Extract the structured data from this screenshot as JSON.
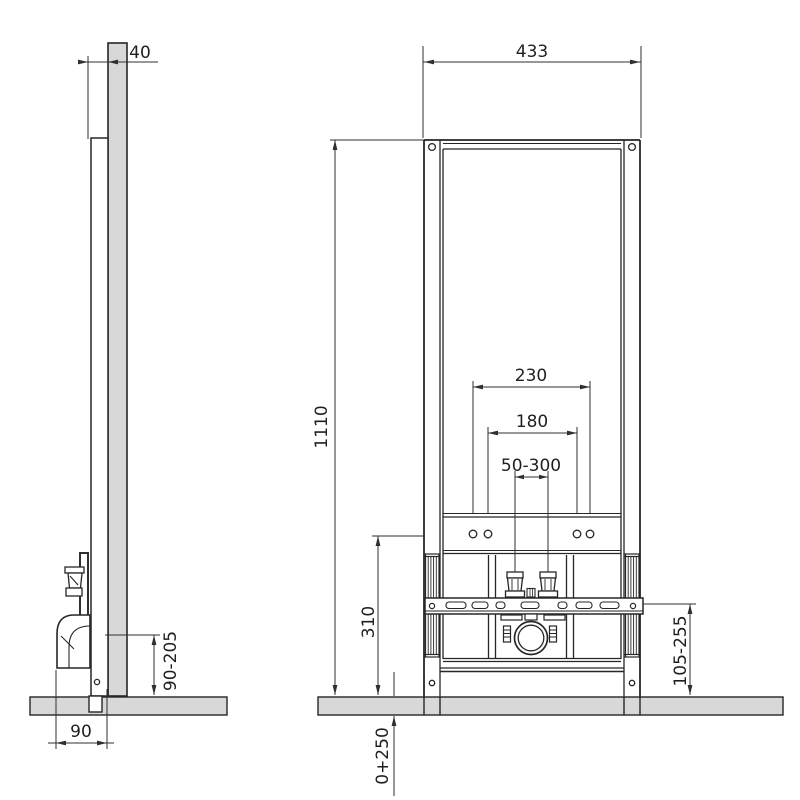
{
  "dimensions": {
    "frame_depth": "40",
    "frame_width": "433",
    "frame_height": "1110",
    "fixing_span_outer": "230",
    "fixing_span_inner": "180",
    "inlet_adjust_range": "50-300",
    "rail_height_above_floor": "310",
    "side_drain_height_range": "90-205",
    "front_drain_height_range": "105-255",
    "foot_adjustment_range": "0+250",
    "drain_offset": "90"
  }
}
